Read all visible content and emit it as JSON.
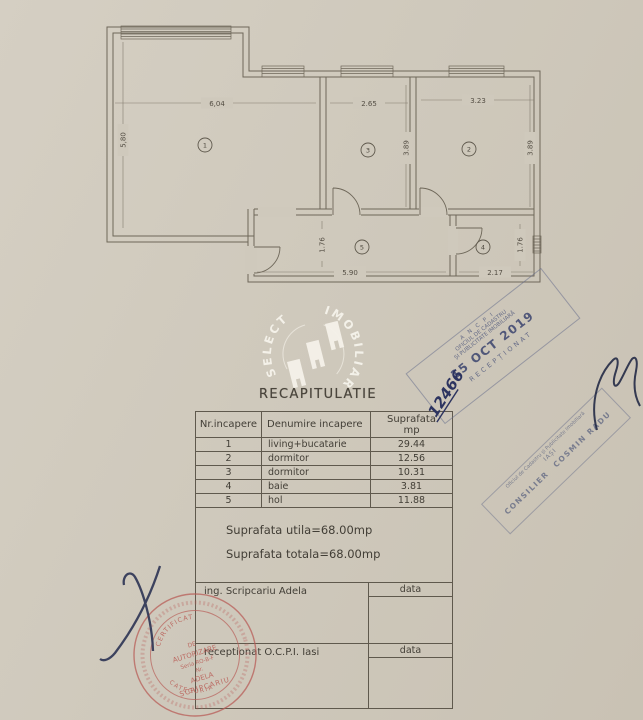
{
  "plan": {
    "rooms": [
      {
        "id": "1",
        "width": "6,04",
        "height": "5,80"
      },
      {
        "id": "2",
        "width": "3.23",
        "height": "3.89"
      },
      {
        "id": "3",
        "width": "2.65",
        "height": "3.89"
      },
      {
        "id": "4",
        "width": "2.17",
        "height": "1.76"
      },
      {
        "id": "5",
        "width": "5.90",
        "height": "1.76"
      }
    ]
  },
  "watermark": {
    "arc_left": "SELECT",
    "arc_right": "IMOBILIARE"
  },
  "recap": {
    "title": "RECAPITULATIE",
    "headers": {
      "col1": "Nr.incapere",
      "col2": "Denumire incapere",
      "col3a": "Suprafata",
      "col3b": "mp"
    },
    "rows": [
      {
        "nr": "1",
        "name": "living+bucatarie",
        "area": "29.44"
      },
      {
        "nr": "2",
        "name": "dormitor",
        "area": "12.56"
      },
      {
        "nr": "3",
        "name": "dormitor",
        "area": "10.31"
      },
      {
        "nr": "4",
        "name": "baie",
        "area": "3.81"
      },
      {
        "nr": "5",
        "name": "hol",
        "area": "11.88"
      }
    ],
    "summary": {
      "utila": "Suprafata utila=68.00mp",
      "totala": "Suprafata totala=68.00mp"
    },
    "sign1": {
      "label": "ing. Scripcariu Adela",
      "date_label": "data"
    },
    "sign2": {
      "label": "receptionat O.C.P.I. Iasi",
      "date_label": "data"
    }
  },
  "stamps": {
    "ancpi": {
      "org": "A N C P I",
      "office1": "OFICIUL DE CADASTRU",
      "office2": "ȘI PUBLICITATE IMOBILIARĂ",
      "date": "15 OCT 2019",
      "status": "RECEPȚIONAT"
    },
    "consilier": {
      "office": "Oficiul de Cadastru și Publicitate Imobiliară",
      "city": "IAȘI",
      "role": "CONSILIER",
      "name": "COSMIN RADU"
    },
    "certificate": {
      "arc_top": "CERTIFICAT",
      "line2": "DE",
      "line3": "AUTORIZARE",
      "line4": "Seria RO-B-F",
      "line5": "Nr.",
      "line6": "ADELA",
      "line7": "SCRIPCARIU",
      "arc_bottom": "CATEGORIA"
    }
  },
  "handwriting": {
    "registration_number": "12466"
  }
}
